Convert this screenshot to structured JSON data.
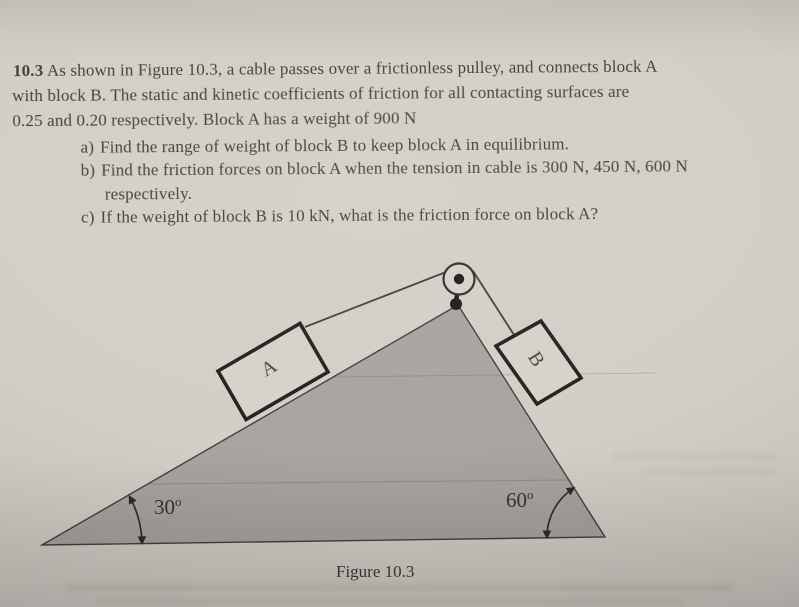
{
  "problem": {
    "number": "10.3",
    "intro_line1": "As shown in Figure 10.3, a cable passes over a frictionless pulley, and connects block A",
    "intro_line2": "with block B. The static and kinetic coefficients of friction for all contacting surfaces are",
    "intro_line3": "0.25 and 0.20 respectively. Block A has a weight of 900 N",
    "items": [
      {
        "label": "a)",
        "text": "Find the range of weight of block B to keep block A in equilibrium."
      },
      {
        "label": "b)",
        "text": "Find the friction forces on block A when the tension in cable is 300 N, 450 N, 600 N",
        "text2": "respectively."
      },
      {
        "label": "c)",
        "text": "If the weight of block B is 10 kN, what is the friction force on block A?"
      }
    ]
  },
  "figure": {
    "block_a_label": "A",
    "block_b_label": "B",
    "angle_left_value": "30",
    "angle_left_sup": "o",
    "angle_right_value": "60",
    "angle_right_sup": "o",
    "caption": "Figure 10.3",
    "colors": {
      "paper": "#d3cfc8",
      "triangle_fill": "#a8a49f",
      "ink": "#3a3733"
    }
  }
}
